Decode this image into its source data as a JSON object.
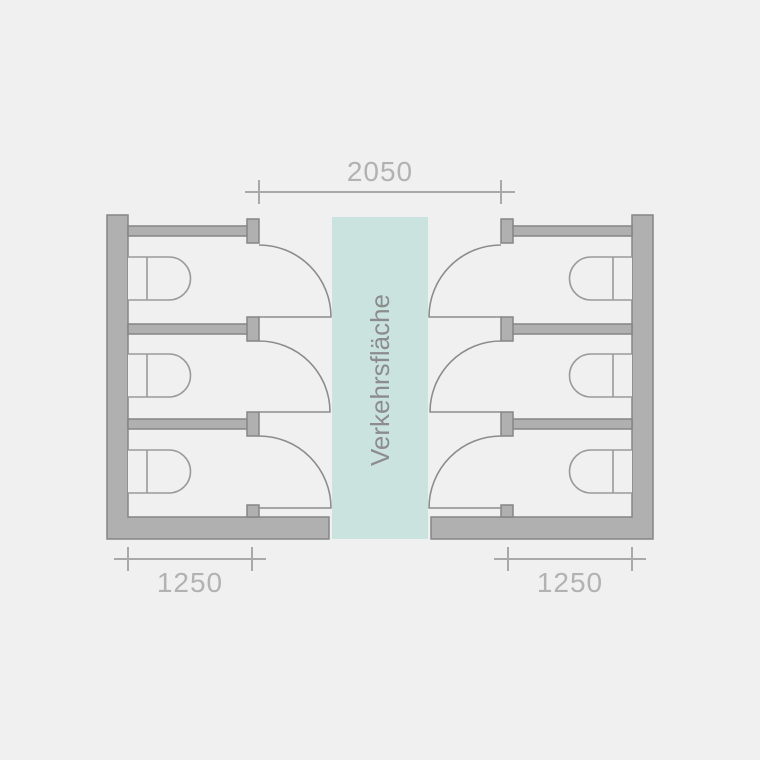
{
  "plan": {
    "corridor": {
      "label": "Verkehrsfläche",
      "width_label": "2050"
    },
    "left_bank": {
      "stall_count": 3,
      "depth_label": "1250"
    },
    "right_bank": {
      "stall_count": 3,
      "depth_label": "1250"
    }
  },
  "colors": {
    "background": "#f0f0f0",
    "wall_fill": "#b0b0b0",
    "wall_stroke": "#858585",
    "corridor_fill": "#cbe3df",
    "door_stroke": "#8c8c8c",
    "fixture_stroke": "#9a9a9a",
    "dimension_line": "#a9a9a9",
    "dimension_text": "#b2b2b2",
    "corridor_text": "#8c8c8c"
  }
}
